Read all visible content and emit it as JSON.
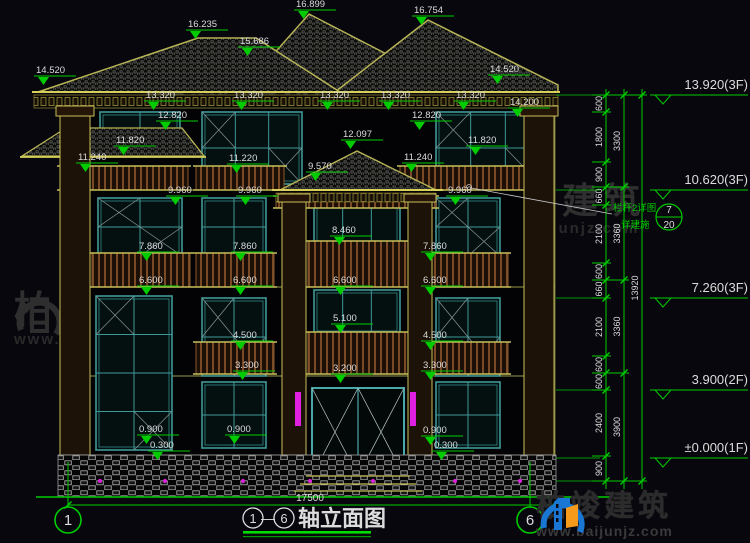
{
  "watermark": {
    "cn": "柏竣建筑",
    "url": "www.baijunjz.com"
  },
  "logo": {
    "cn": "柏竣建筑",
    "url": "www.baijunjz.com"
  },
  "drawing_title": {
    "axis_start": "1",
    "dash": "—",
    "axis_end": "6",
    "text": "轴立面图"
  },
  "ground_dimension": "17500",
  "axis_bubbles": [
    {
      "n": "1",
      "x": 68
    },
    {
      "n": "6",
      "x": 530
    }
  ],
  "elevation_markers": [
    {
      "t": "16.235",
      "x": 188,
      "y": 27
    },
    {
      "t": "16.899",
      "x": 296,
      "y": 7
    },
    {
      "t": "16.754",
      "x": 414,
      "y": 13
    },
    {
      "t": "15.686",
      "x": 240,
      "y": 44
    },
    {
      "t": "14.520",
      "x": 36,
      "y": 73
    },
    {
      "t": "14.520",
      "x": 490,
      "y": 72
    },
    {
      "t": "14.200",
      "x": 510,
      "y": 105
    },
    {
      "t": "13.320",
      "x": 146,
      "y": 98
    },
    {
      "t": "13.320",
      "x": 234,
      "y": 98
    },
    {
      "t": "13.320",
      "x": 320,
      "y": 98
    },
    {
      "t": "13.320",
      "x": 381,
      "y": 98
    },
    {
      "t": "13.320",
      "x": 456,
      "y": 98
    },
    {
      "t": "12.820",
      "x": 158,
      "y": 118
    },
    {
      "t": "12.820",
      "x": 412,
      "y": 118
    },
    {
      "t": "12.097",
      "x": 343,
      "y": 137
    },
    {
      "t": "11.820",
      "x": 116,
      "y": 143
    },
    {
      "t": "11.820",
      "x": 468,
      "y": 143
    },
    {
      "t": "11.240",
      "x": 78,
      "y": 160
    },
    {
      "t": "11.220",
      "x": 229,
      "y": 161
    },
    {
      "t": "11.240",
      "x": 404,
      "y": 160
    },
    {
      "t": "9.960",
      "x": 168,
      "y": 193
    },
    {
      "t": "9.960",
      "x": 238,
      "y": 193
    },
    {
      "t": "9.960",
      "x": 448,
      "y": 193
    },
    {
      "t": "9.570",
      "x": 308,
      "y": 169
    },
    {
      "t": "8.460",
      "x": 332,
      "y": 233
    },
    {
      "t": "7.860",
      "x": 139,
      "y": 249
    },
    {
      "t": "7.860",
      "x": 233,
      "y": 249
    },
    {
      "t": "7.860",
      "x": 423,
      "y": 249
    },
    {
      "t": "6.600",
      "x": 139,
      "y": 283
    },
    {
      "t": "6.600",
      "x": 233,
      "y": 283
    },
    {
      "t": "6.600",
      "x": 333,
      "y": 283
    },
    {
      "t": "6.600",
      "x": 423,
      "y": 283
    },
    {
      "t": "5.100",
      "x": 333,
      "y": 321
    },
    {
      "t": "4.500",
      "x": 233,
      "y": 338
    },
    {
      "t": "4.500",
      "x": 423,
      "y": 338
    },
    {
      "t": "3.300",
      "x": 235,
      "y": 368
    },
    {
      "t": "3.300",
      "x": 423,
      "y": 368
    },
    {
      "t": "3.200",
      "x": 333,
      "y": 371
    },
    {
      "t": "0.900",
      "x": 139,
      "y": 432
    },
    {
      "t": "0.900",
      "x": 227,
      "y": 432
    },
    {
      "t": "0.900",
      "x": 423,
      "y": 433
    },
    {
      "t": "0.300",
      "x": 150,
      "y": 448
    },
    {
      "t": "0.300",
      "x": 434,
      "y": 448
    }
  ],
  "right_elevations": [
    {
      "t": "13.920(3F)",
      "y": 95
    },
    {
      "t": "10.620(3F)",
      "y": 190
    },
    {
      "t": "7.260(3F)",
      "y": 298
    },
    {
      "t": "3.900(2F)",
      "y": 390
    },
    {
      "t": "±0.000(1F)",
      "y": 458
    }
  ],
  "dim_chains": [
    {
      "x": 606,
      "ticks": [
        95,
        112,
        162,
        187,
        205,
        263,
        280,
        298,
        356,
        373,
        390,
        456,
        481
      ],
      "values": [
        "600",
        "1800",
        "900",
        "660",
        "2100",
        "600",
        "660",
        "2100",
        "600",
        "600",
        "2400",
        "900"
      ]
    },
    {
      "x": 624,
      "ticks": [
        95,
        187,
        280,
        373,
        481
      ],
      "values": [
        "3300",
        "3360",
        "3360",
        "3900"
      ]
    },
    {
      "x": 642,
      "ticks": [
        95,
        481
      ],
      "values": [
        "13920"
      ]
    }
  ],
  "detail_callout": {
    "line1": "栏杆2详图",
    "line2": "详建施",
    "num": "7",
    "den": "20"
  },
  "colors": {
    "dim_green": "#00cc00",
    "text_white": "#dcdcdc",
    "outline_yellow": "#c8bf58",
    "window_teal": "#3f9898",
    "rail_brown": "#7a4a26",
    "lamp_magenta": "#e020e0",
    "logo_blue": "#1976d2",
    "logo_orange": "#f59a1a"
  }
}
